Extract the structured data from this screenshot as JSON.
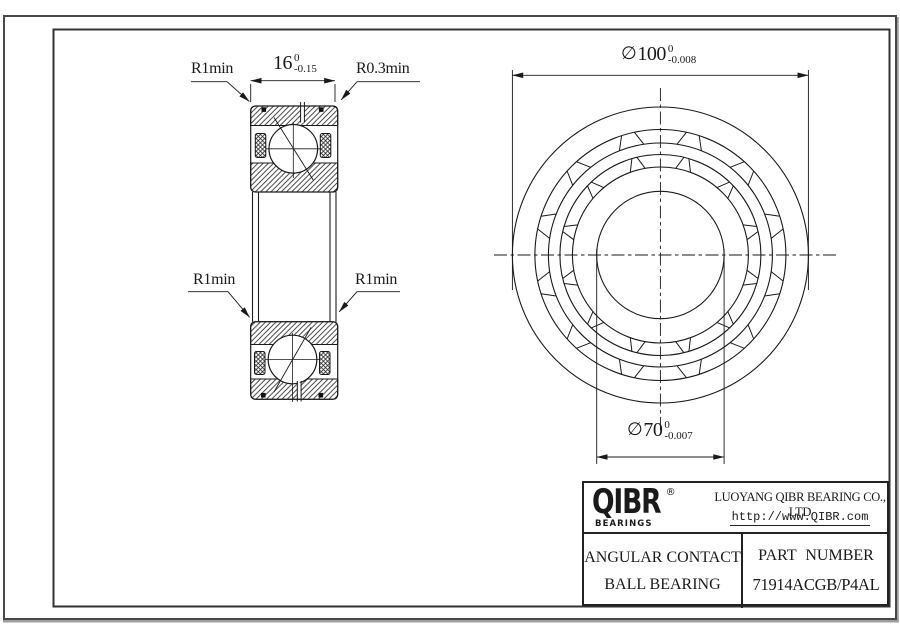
{
  "section_view": {
    "fillet_top_left": "R1min",
    "fillet_top_right": "R0.3min",
    "fillet_mid_left": "R1min",
    "fillet_mid_right": "R1min",
    "width_dim": {
      "value": "16",
      "tol_upper": "0",
      "tol_lower": "-0.15"
    }
  },
  "front_view": {
    "outer_dia": {
      "symbol": "∅",
      "value": "100",
      "tol_upper": "0",
      "tol_lower": "-0.008"
    },
    "bore_dia": {
      "symbol": "∅",
      "value": "70",
      "tol_upper": "0",
      "tol_lower": "-0.007"
    }
  },
  "title_block": {
    "brand": "QIBR",
    "registered": "®",
    "brand_sub": "BEARINGS",
    "company": "LUOYANG QIBR BEARING CO., LTD",
    "website": "http://www.QIBR.com",
    "product_line1": "ANGULAR CONTACT",
    "product_line2": "BALL BEARING",
    "part_number_label": "PART NUMBER",
    "part_number": "71914ACGB/P4AL"
  },
  "colors": {
    "line": "#1a1a1a",
    "frame": "#333333",
    "shadow": "#9e9e9e"
  }
}
